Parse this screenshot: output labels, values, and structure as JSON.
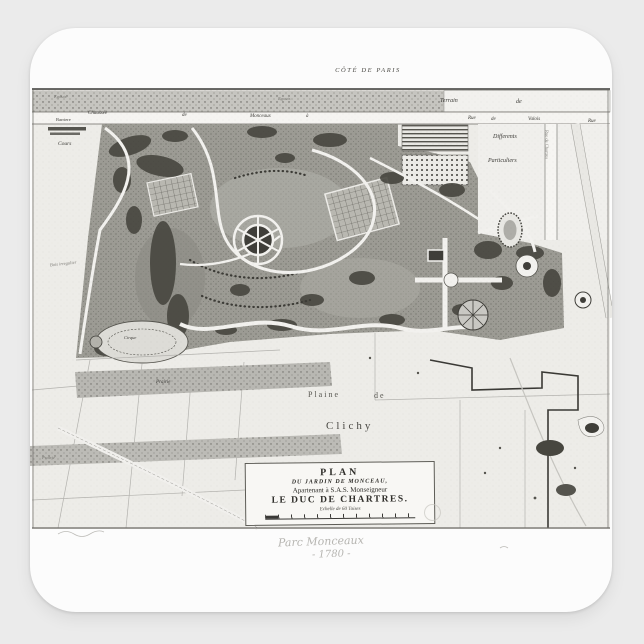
{
  "product": {
    "background_color": "#ebebeb",
    "sticker_color": "#fcfcfc",
    "description": "square sticker with antique engraved map"
  },
  "map": {
    "top_label": "Côté de Paris",
    "labels": {
      "egouts_left": "Egouts",
      "egouts_center": "Egouts",
      "chaussee": "Chaussée",
      "de_road": "de",
      "monceaux": "Monceaux",
      "a_road": "à",
      "barriere": "Barriere",
      "cours": "Cours",
      "terrain": "Terrain",
      "terrain_de": "de",
      "rue1": "Rue",
      "rue_de": "de",
      "valois": "Valois",
      "rue2": "Rue",
      "rue_chartres": "Rue de Chartres",
      "differents": "Differents",
      "particuliers": "Particuliers",
      "bois_irregulier": "Bois irregulier",
      "cirque": "Cirque",
      "prairie_upper": "Prairie",
      "prairie_lower": "Prairie",
      "plaine": "Plaine",
      "plaine_de": "de",
      "clichy": "Clichy"
    },
    "cartouche": {
      "title": "PLAN",
      "line2": "DU JARDIN DE MONCEAU,",
      "line3": "Apartenant à S.A.S. Monseigneur",
      "line4": "LE DUC DE CHARTRES.",
      "scale_label": "Echelle de 60 Toises"
    },
    "handwriting": {
      "line1": "Parc Monceaux",
      "line2": "- 1780 -"
    }
  }
}
